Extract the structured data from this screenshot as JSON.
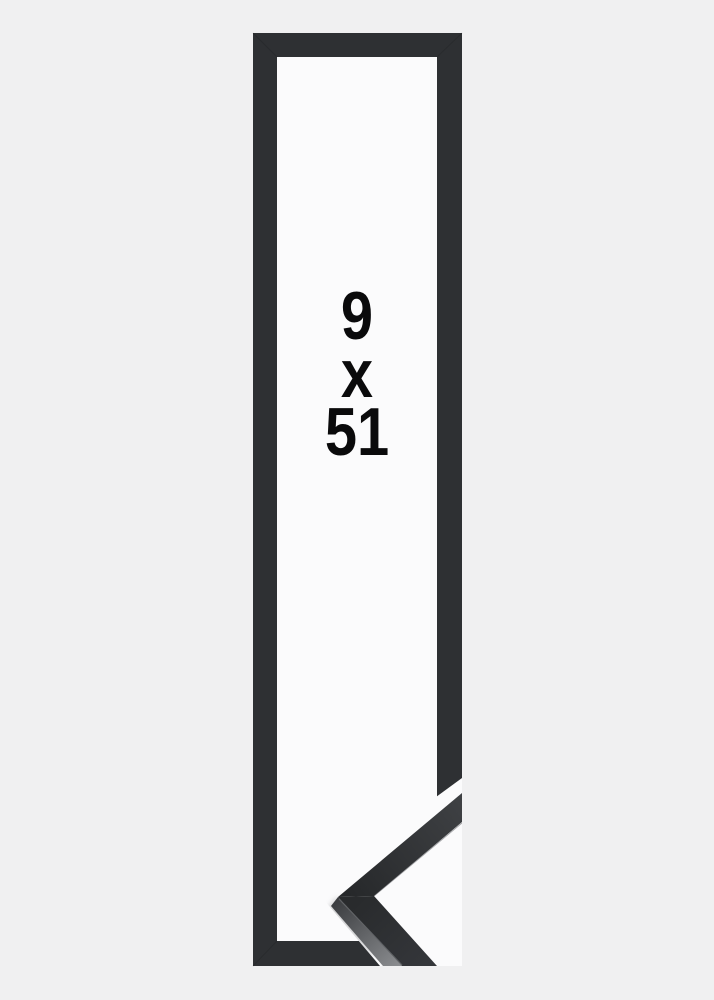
{
  "size_label": {
    "width": "9",
    "separator": "x",
    "height": "51",
    "full_text": "9 x 51"
  },
  "colors": {
    "background": "#f0f0f1",
    "paper": "#fbfbfc",
    "frame": "#2e3033",
    "chevron_light": "#3e4043",
    "chevron_dark": "#26282a",
    "chevron_lower_near": "#292b2d",
    "chevron_lower_far": "#34363a",
    "side_face_dark": "#3c3e41",
    "side_face_light": "#8a8c8f",
    "text": "#0a0a0b"
  }
}
